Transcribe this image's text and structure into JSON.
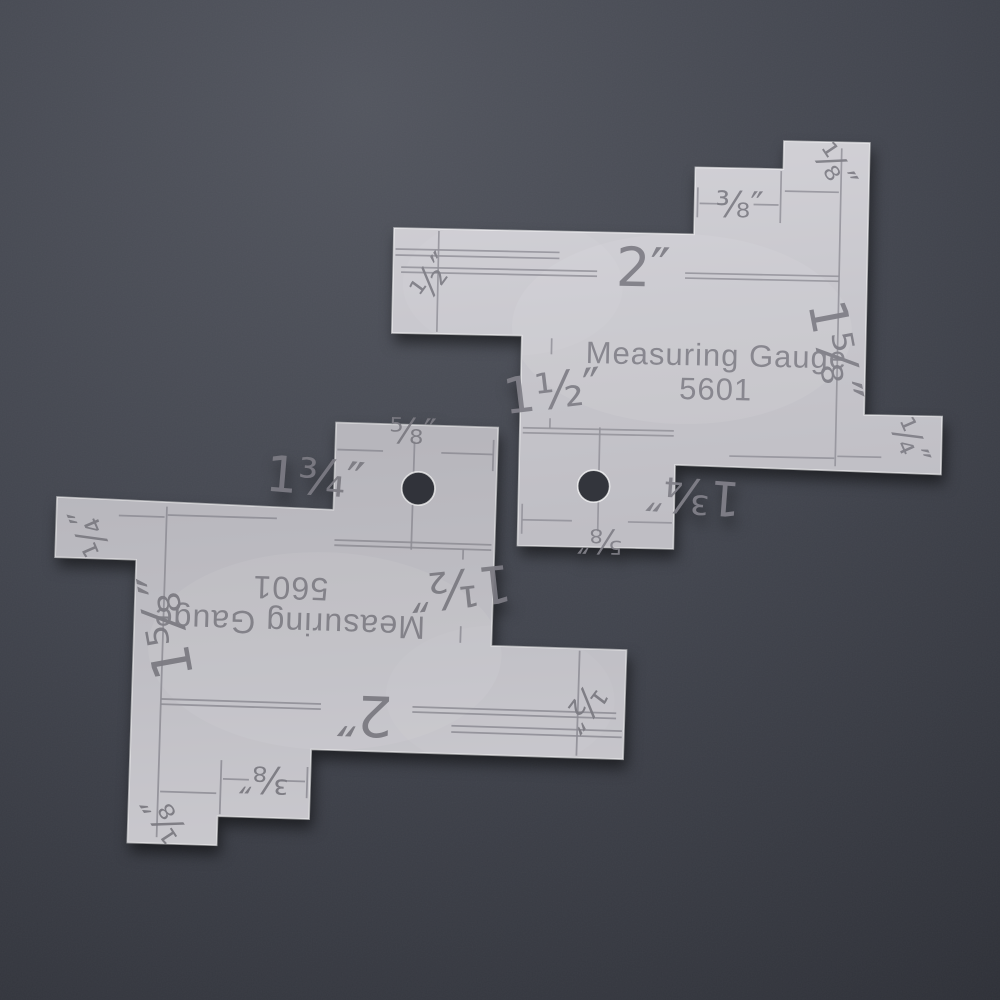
{
  "photo": {
    "background": {
      "top": "#53565f",
      "mid": "#42454e",
      "bottom": "#2b2d34"
    },
    "plate_color_light": "#d3d2d7",
    "plate_color_dark": "#bfbec4",
    "engraving_color": "#8a8990"
  },
  "gauge": {
    "title_line1": "Measuring Gauge",
    "title_line2": "5601",
    "labels": {
      "half": "½″",
      "two": "2″",
      "three_eighths": "⅜″",
      "one_eighth": "⅛″",
      "one_five_eighths": "1⅝″",
      "one_and_a_half": "1½″",
      "one_three_quarters": "1¾″",
      "five_eighths": "⅝″",
      "one_quarter": "¼″"
    }
  },
  "gauges": [
    {
      "name": "gauge-top-right",
      "orientation": "text upright"
    },
    {
      "name": "gauge-bottom-left",
      "orientation": "rotated 180°"
    }
  ]
}
